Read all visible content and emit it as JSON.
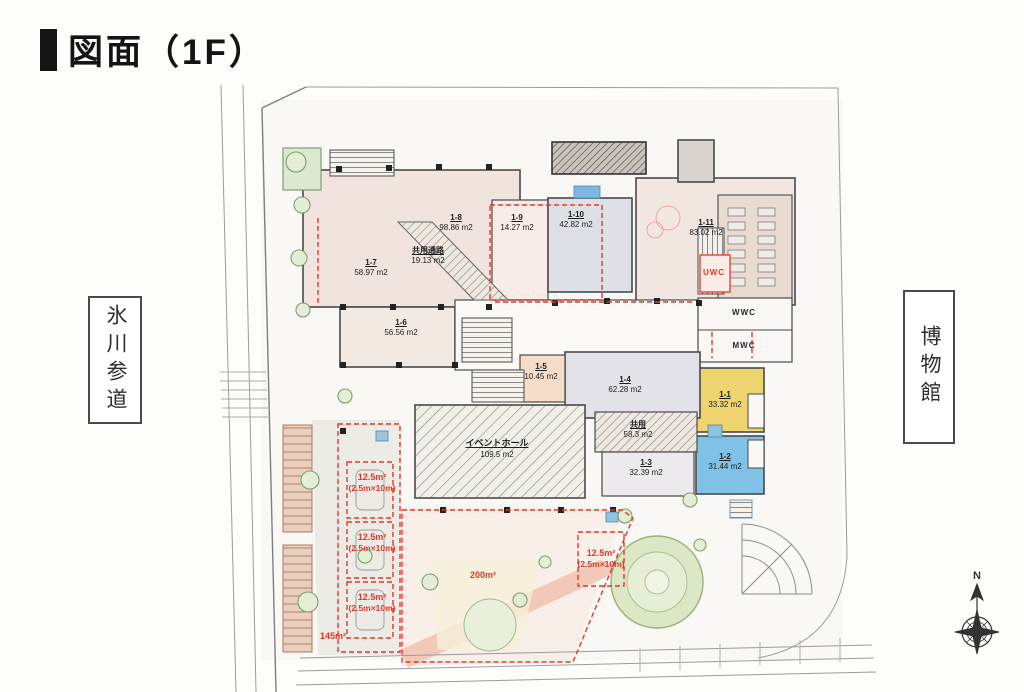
{
  "page": {
    "title": "図面（1F）"
  },
  "surroundings": {
    "left_street": "氷川参道",
    "right_site": "博物館",
    "compass_north": "N"
  },
  "rooms": [
    {
      "id": "1-8",
      "area": "98.86 m2"
    },
    {
      "id": "1-9",
      "area": "14.27 m2"
    },
    {
      "id": "1-10",
      "area": "42.82 m2"
    },
    {
      "id": "1-11",
      "area": "83.02 m2"
    },
    {
      "id": "1-7",
      "area": "58.97 m2"
    },
    {
      "id": "共用通路",
      "area": "19.13 m2"
    },
    {
      "id": "1-6",
      "area": "56.56 m2"
    },
    {
      "id": "1-5",
      "area": "10.45 m2"
    },
    {
      "id": "1-4",
      "area": "62.28 m2"
    },
    {
      "id": "1-1",
      "area": "33.32 m2"
    },
    {
      "id": "1-2",
      "area": "31.44 m2"
    },
    {
      "id": "イベントホール",
      "area": "109.5 m2"
    },
    {
      "id": "共用",
      "area": "58.3 m2"
    },
    {
      "id": "1-3",
      "area": "32.39 m2"
    }
  ],
  "wc": {
    "uwc": "UWC",
    "wwc": "WWC",
    "mwc": "MWC"
  },
  "red_annotations": {
    "space_line1": "12.5m²",
    "space_line2": "(2.5m×10m)",
    "area_145": "145m²",
    "area_200": "200m²"
  },
  "colors": {
    "accent_red": "#e0392a",
    "room_yellow": "#eed46e",
    "room_blue": "#7fc2e5",
    "room_gray": "#dfdfe8",
    "room_pink": "#f2e5df",
    "garden_green": "#dce7c6"
  }
}
